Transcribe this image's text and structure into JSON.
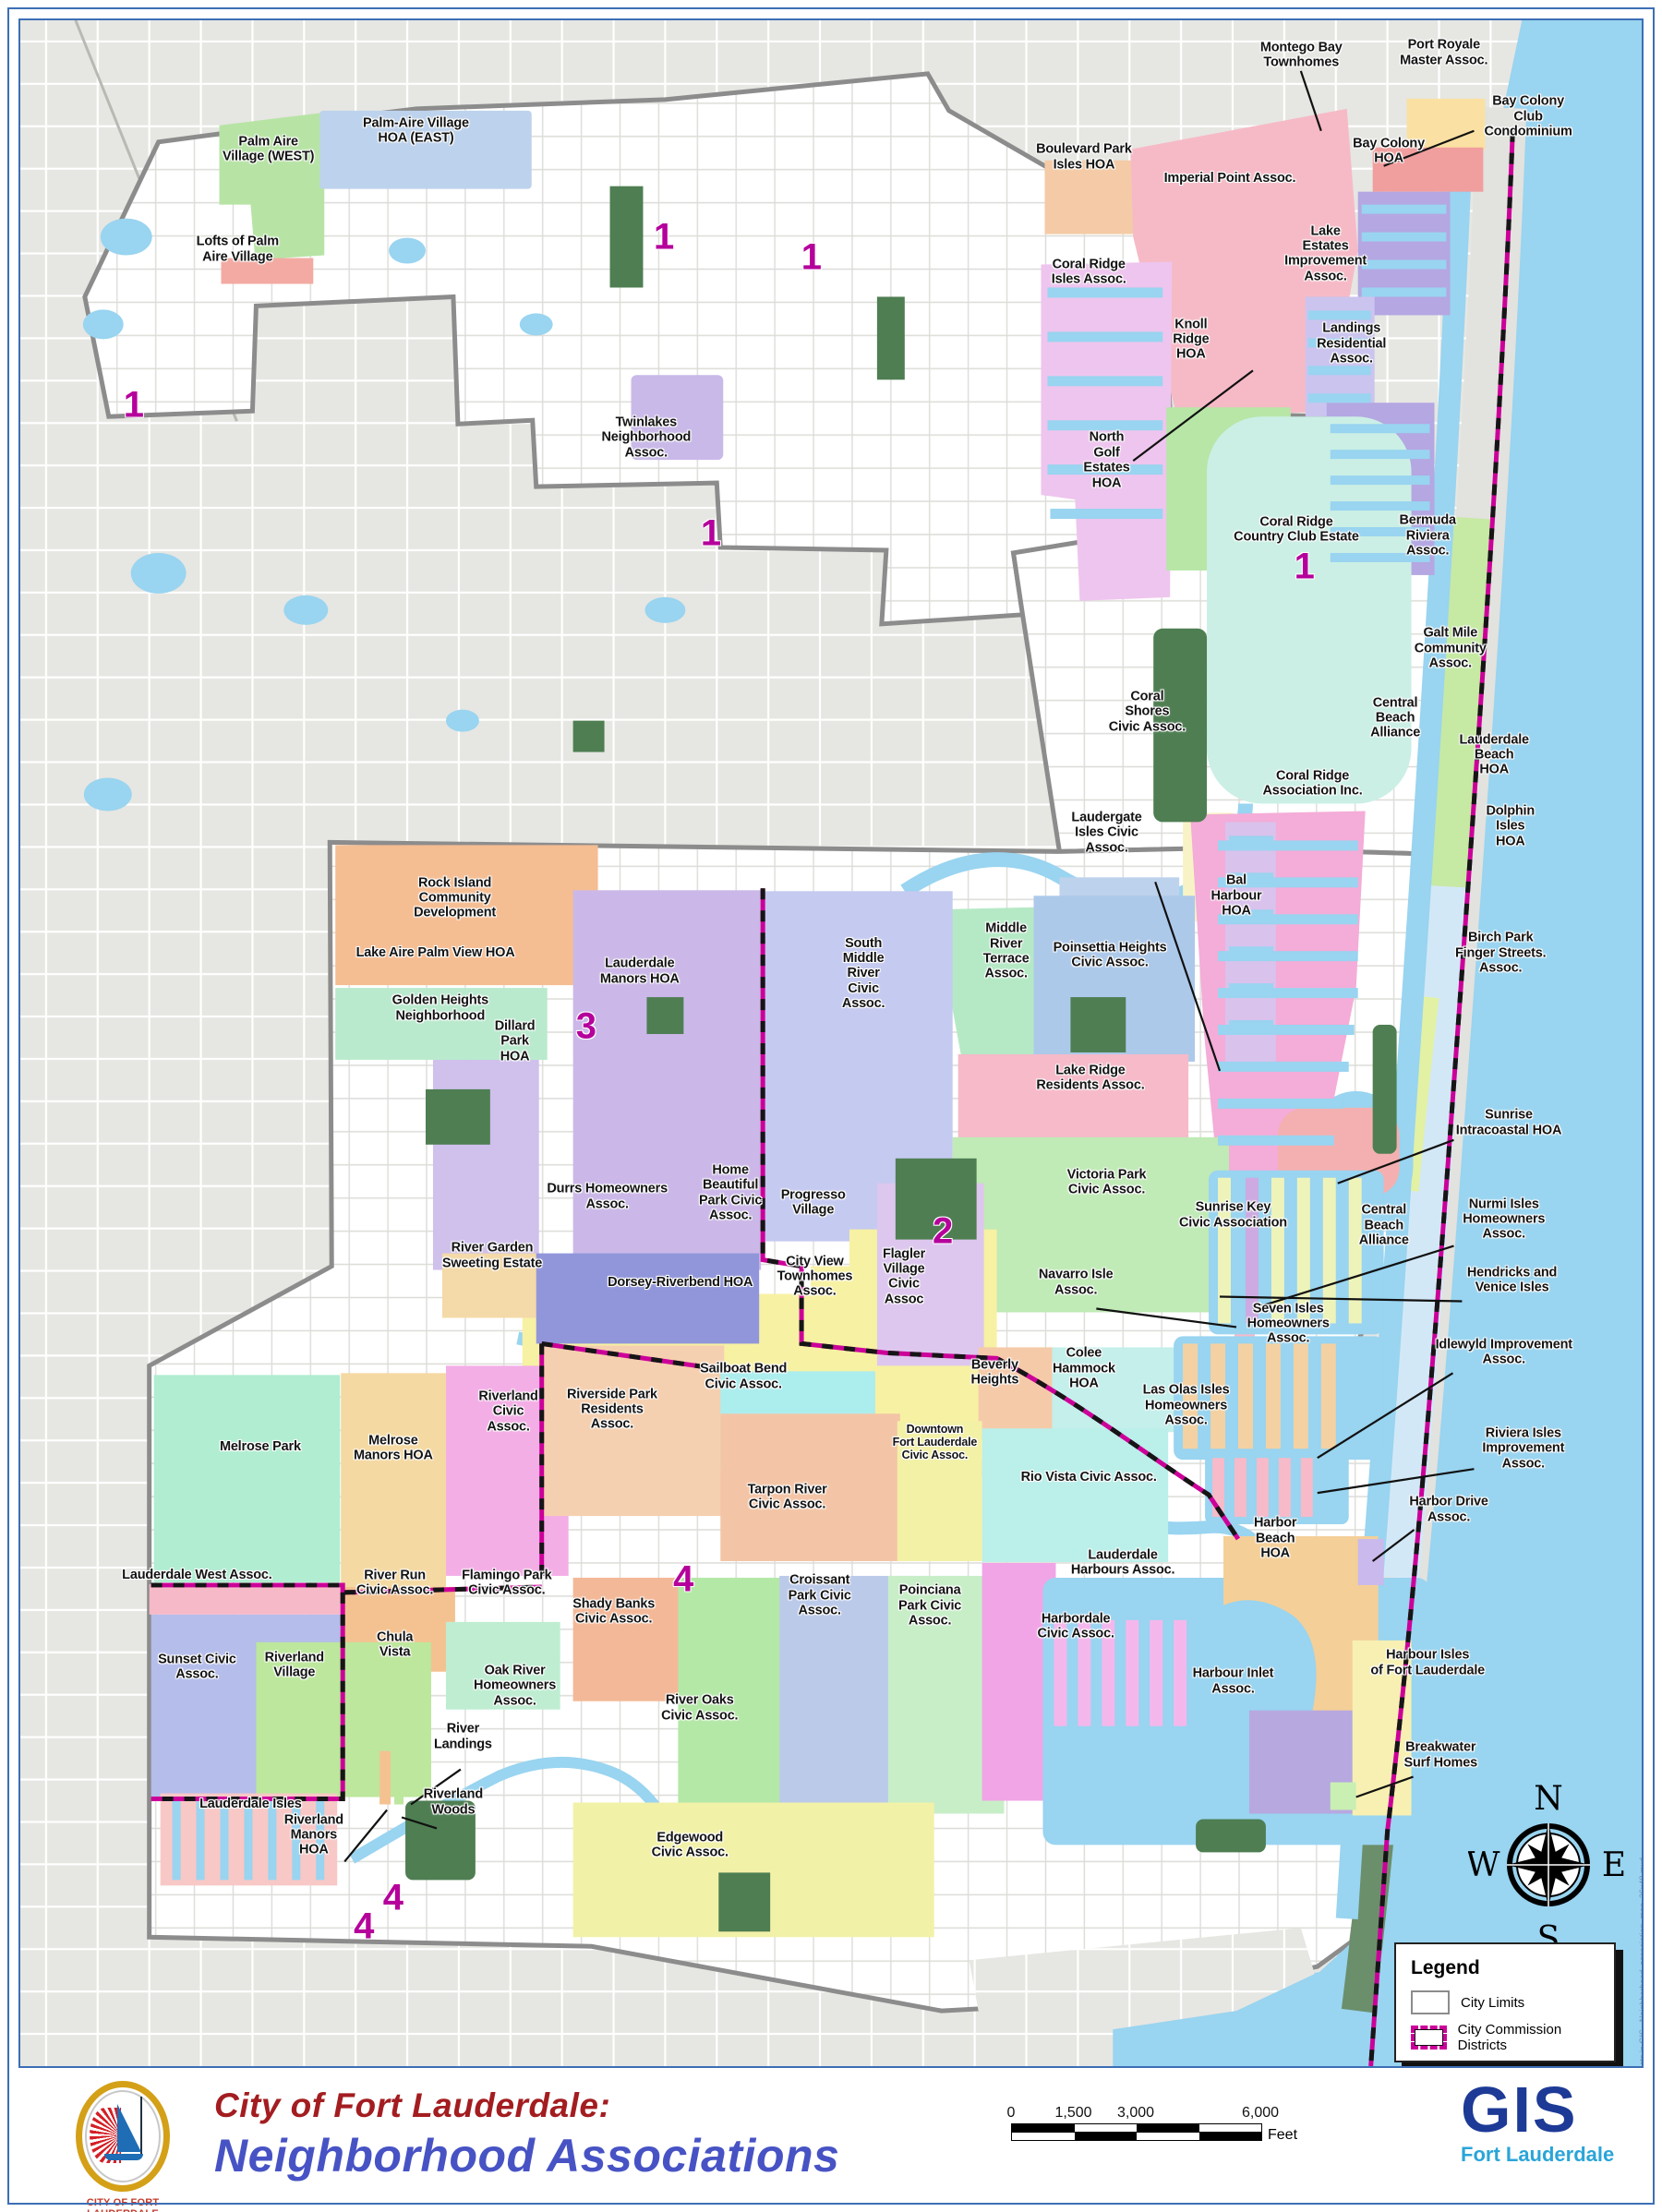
{
  "map": {
    "side_note": "Projects in GIS - Neighborhood_association_map_36x48.mxd",
    "labels": [
      {
        "id": "palm-aire-west",
        "text": "Palm Aire\nVillage (WEST)",
        "x": 15.3,
        "y": 6.3
      },
      {
        "id": "palm-aire-east",
        "text": "Palm-Aire Village\nHOA (EAST)",
        "x": 24.4,
        "y": 5.4
      },
      {
        "id": "lofts-of-palm-aire",
        "text": "Lofts of Palm\nAire Village",
        "x": 13.4,
        "y": 11.2
      },
      {
        "id": "twinlakes",
        "text": "Twinlakes\nNeighborhood\nAssoc.",
        "x": 38.6,
        "y": 20.4
      },
      {
        "id": "montego-bay",
        "text": "Montego Bay\nTownhomes",
        "x": 79.0,
        "y": 1.7
      },
      {
        "id": "port-royale",
        "text": "Port Royale\nMaster Assoc.",
        "x": 87.8,
        "y": 1.6
      },
      {
        "id": "bay-colony-club",
        "text": "Bay Colony\nClub Condominium",
        "x": 93.0,
        "y": 4.7
      },
      {
        "id": "bay-colony-hoa",
        "text": "Bay Colony\nHOA",
        "x": 84.4,
        "y": 6.4
      },
      {
        "id": "boulevard-park-isles",
        "text": "Boulevard Park\nIsles HOA",
        "x": 65.6,
        "y": 6.7
      },
      {
        "id": "imperial-point",
        "text": "Imperial Point Assoc.",
        "x": 74.6,
        "y": 7.7
      },
      {
        "id": "lake-estates",
        "text": "Lake\nEstates\nImprovement\nAssoc.",
        "x": 80.5,
        "y": 11.4
      },
      {
        "id": "coral-ridge-isles",
        "text": "Coral Ridge\nIsles Assoc.",
        "x": 65.9,
        "y": 12.3
      },
      {
        "id": "knoll-ridge",
        "text": "Knoll\nRidge\nHOA",
        "x": 72.2,
        "y": 15.6
      },
      {
        "id": "landings-residential",
        "text": "Landings\nResidential\nAssoc.",
        "x": 82.1,
        "y": 15.8
      },
      {
        "id": "north-golf-estates",
        "text": "North\nGolf\nEstates\nHOA",
        "x": 67.0,
        "y": 21.5
      },
      {
        "id": "coral-ridge-cc",
        "text": "Coral Ridge\nCountry Club Estate",
        "x": 78.7,
        "y": 24.9
      },
      {
        "id": "bermuda-riviera",
        "text": "Bermuda\nRiviera\nAssoc.",
        "x": 86.8,
        "y": 25.2
      },
      {
        "id": "galt-mile",
        "text": "Galt Mile\nCommunity\nAssoc.",
        "x": 88.2,
        "y": 30.7
      },
      {
        "id": "coral-shores",
        "text": "Coral\nShores\nCivic Assoc.",
        "x": 69.5,
        "y": 33.8
      },
      {
        "id": "central-beach-n",
        "text": "Central\nBeach\nAlliance",
        "x": 84.8,
        "y": 34.1
      },
      {
        "id": "lauderdale-beach",
        "text": "Lauderdale\nBeach\nHOA",
        "x": 90.9,
        "y": 35.9
      },
      {
        "id": "coral-ridge-assoc",
        "text": "Coral Ridge\nAssociation Inc.",
        "x": 79.7,
        "y": 37.3
      },
      {
        "id": "dolphin-isles",
        "text": "Dolphin\nIsles\nHOA",
        "x": 91.9,
        "y": 39.4
      },
      {
        "id": "laudergate-isles",
        "text": "Laudergate\nIsles Civic\nAssoc.",
        "x": 67.0,
        "y": 39.7
      },
      {
        "id": "bal-harbour",
        "text": "Bal\nHarbour\nHOA",
        "x": 75.0,
        "y": 42.8
      },
      {
        "id": "birch-park",
        "text": "Birch Park\nFinger Streets.\nAssoc.",
        "x": 91.3,
        "y": 45.6
      },
      {
        "id": "middle-river-terrace",
        "text": "Middle\nRiver\nTerrace\nAssoc.",
        "x": 60.8,
        "y": 45.5
      },
      {
        "id": "poinsettia-heights",
        "text": "Poinsettia Heights\nCivic Assoc.",
        "x": 67.2,
        "y": 45.7
      },
      {
        "id": "south-middle-river",
        "text": "South\nMiddle\nRiver\nCivic\nAssoc.",
        "x": 52.0,
        "y": 46.6
      },
      {
        "id": "rock-island",
        "text": "Rock Island\nCommunity\nDevelopment",
        "x": 26.8,
        "y": 42.9
      },
      {
        "id": "lake-aire-palm-view",
        "text": "Lake Aire Palm View HOA",
        "x": 25.6,
        "y": 45.6
      },
      {
        "id": "golden-heights",
        "text": "Golden Heights\nNeighborhood",
        "x": 25.9,
        "y": 48.3
      },
      {
        "id": "dillard-park",
        "text": "Dillard\nPark\nHOA",
        "x": 30.5,
        "y": 49.9
      },
      {
        "id": "lauderdale-manors",
        "text": "Lauderdale\nManors HOA",
        "x": 38.2,
        "y": 46.5
      },
      {
        "id": "lake-ridge",
        "text": "Lake Ridge\nResidents Assoc.",
        "x": 66.0,
        "y": 51.7
      },
      {
        "id": "sunrise-intracoastal",
        "text": "Sunrise\nIntracoastal HOA",
        "x": 91.8,
        "y": 53.9
      },
      {
        "id": "victoria-park",
        "text": "Victoria Park\nCivic Assoc.",
        "x": 67.0,
        "y": 56.8
      },
      {
        "id": "sunrise-key",
        "text": "Sunrise Key\nCivic Association",
        "x": 74.8,
        "y": 58.4
      },
      {
        "id": "central-beach-s",
        "text": "Central\nBeach\nAlliance",
        "x": 84.1,
        "y": 58.9
      },
      {
        "id": "nurmi-isles",
        "text": "Nurmi Isles\nHomeowners\nAssoc.",
        "x": 91.5,
        "y": 58.6
      },
      {
        "id": "durrs",
        "text": "Durrs Homeowners\nAssoc.",
        "x": 36.2,
        "y": 57.5
      },
      {
        "id": "home-beautiful",
        "text": "Home\nBeautiful\nPark Civic\nAssoc.",
        "x": 43.8,
        "y": 57.3
      },
      {
        "id": "progresso-village",
        "text": "Progresso\nVillage",
        "x": 48.9,
        "y": 57.8
      },
      {
        "id": "river-garden",
        "text": "River Garden\nSweeting Estate",
        "x": 29.1,
        "y": 60.4
      },
      {
        "id": "dorsey-riverbend",
        "text": "Dorsey-Riverbend HOA",
        "x": 40.7,
        "y": 61.7
      },
      {
        "id": "city-view",
        "text": "City View\nTownhomes\nAssoc.",
        "x": 49.0,
        "y": 61.4
      },
      {
        "id": "flagler-village",
        "text": "Flagler\nVillage\nCivic\nAssoc",
        "x": 54.5,
        "y": 61.4
      },
      {
        "id": "navarro-isle",
        "text": "Navarro Isle\nAssoc.",
        "x": 65.1,
        "y": 61.7
      },
      {
        "id": "hendricks-venice",
        "text": "Hendricks and\nVenice Isles",
        "x": 92.0,
        "y": 61.6
      },
      {
        "id": "seven-isles",
        "text": "Seven Isles\nHomeowners\nAssoc.",
        "x": 78.2,
        "y": 63.7
      },
      {
        "id": "idlewyld",
        "text": "Idlewyld Improvement\nAssoc.",
        "x": 91.5,
        "y": 65.1
      },
      {
        "id": "melrose-park",
        "text": "Melrose Park",
        "x": 14.8,
        "y": 69.7
      },
      {
        "id": "melrose-manors",
        "text": "Melrose\nManors HOA",
        "x": 23.0,
        "y": 69.8
      },
      {
        "id": "riverland-civic",
        "text": "Riverland\nCivic\nAssoc.",
        "x": 30.1,
        "y": 68.0
      },
      {
        "id": "riverside-park",
        "text": "Riverside Park\nResidents\nAssoc.",
        "x": 36.5,
        "y": 67.9
      },
      {
        "id": "sailboat-bend",
        "text": "Sailboat Bend\nCivic Assoc.",
        "x": 44.6,
        "y": 66.3
      },
      {
        "id": "beverly-heights",
        "text": "Beverly\nHeights",
        "x": 60.1,
        "y": 66.1
      },
      {
        "id": "colee-hammock",
        "text": "Colee\nHammock\nHOA",
        "x": 65.6,
        "y": 65.9
      },
      {
        "id": "las-olas-isles",
        "text": "Las Olas Isles\nHomeowners\nAssoc.",
        "x": 71.9,
        "y": 67.7
      },
      {
        "id": "downtown",
        "text": "Downtown\nFort Lauderdale\nCivic Assoc.",
        "x": 56.4,
        "y": 69.5,
        "size": "sm"
      },
      {
        "id": "rio-vista",
        "text": "Rio Vista Civic Assoc.",
        "x": 65.9,
        "y": 71.2
      },
      {
        "id": "riviera-isles",
        "text": "Riviera Isles\nImprovement\nAssoc.",
        "x": 92.7,
        "y": 69.8
      },
      {
        "id": "tarpon-river",
        "text": "Tarpon River\nCivic Assoc.",
        "x": 47.3,
        "y": 72.2
      },
      {
        "id": "harbor-drive",
        "text": "Harbor Drive\nAssoc.",
        "x": 88.1,
        "y": 72.8
      },
      {
        "id": "harbor-beach",
        "text": "Harbor\nBeach\nHOA",
        "x": 77.4,
        "y": 74.2
      },
      {
        "id": "lauderdale-harbours",
        "text": "Lauderdale\nHarbours Assoc.",
        "x": 68.0,
        "y": 75.4
      },
      {
        "id": "lauderdale-west",
        "text": "Lauderdale West  Assoc.",
        "x": 10.9,
        "y": 76.0
      },
      {
        "id": "river-run",
        "text": "River Run\nCivic Assoc.",
        "x": 23.1,
        "y": 76.4
      },
      {
        "id": "flamingo-park",
        "text": "Flamingo Park\nCivic Assoc.",
        "x": 30.0,
        "y": 76.4
      },
      {
        "id": "shady-banks",
        "text": "Shady Banks\nCivic Assoc.",
        "x": 36.6,
        "y": 77.8
      },
      {
        "id": "croissant-park",
        "text": "Croissant\nPark Civic\nAssoc.",
        "x": 49.3,
        "y": 77.0
      },
      {
        "id": "poinciana-park",
        "text": "Poinciana\nPark Civic\nAssoc.",
        "x": 56.1,
        "y": 77.5
      },
      {
        "id": "harbordale",
        "text": "Harbordale\nCivic Assoc.",
        "x": 65.1,
        "y": 78.5
      },
      {
        "id": "harbour-inlet",
        "text": "Harbour Inlet\nAssoc.",
        "x": 74.8,
        "y": 81.2
      },
      {
        "id": "harbour-isles",
        "text": "Harbour Isles\nof Fort Lauderdale",
        "x": 86.8,
        "y": 80.3
      },
      {
        "id": "sunset-civic",
        "text": "Sunset Civic\nAssoc.",
        "x": 10.9,
        "y": 80.5
      },
      {
        "id": "riverland-village",
        "text": "Riverland\nVillage",
        "x": 16.9,
        "y": 80.4
      },
      {
        "id": "chula-vista",
        "text": "Chula\nVista",
        "x": 23.1,
        "y": 79.4
      },
      {
        "id": "oak-river",
        "text": "Oak River\nHomeowners\nAssoc.",
        "x": 30.5,
        "y": 81.4
      },
      {
        "id": "river-oaks",
        "text": "River Oaks\nCivic Assoc.",
        "x": 41.9,
        "y": 82.5
      },
      {
        "id": "breakwater",
        "text": "Breakwater\nSurf Homes",
        "x": 87.6,
        "y": 84.8
      },
      {
        "id": "river-landings",
        "text": "River\nLandings",
        "x": 27.3,
        "y": 83.9
      },
      {
        "id": "lauderdale-isles",
        "text": "Lauderdale Isles",
        "x": 14.2,
        "y": 87.2
      },
      {
        "id": "riverland-woods",
        "text": "Riverland\nWoods",
        "x": 26.7,
        "y": 87.1
      },
      {
        "id": "riverland-manors",
        "text": "Riverland\nManors\nHOA",
        "x": 18.1,
        "y": 88.7
      },
      {
        "id": "edgewood",
        "text": "Edgewood\nCivic Assoc.",
        "x": 41.3,
        "y": 89.2
      }
    ],
    "district_numbers": [
      {
        "n": "1",
        "x": 39.7,
        "y": 10.6
      },
      {
        "n": "1",
        "x": 7.0,
        "y": 18.8
      },
      {
        "n": "1",
        "x": 48.8,
        "y": 11.6
      },
      {
        "n": "1",
        "x": 42.6,
        "y": 25.1
      },
      {
        "n": "1",
        "x": 79.2,
        "y": 26.7
      },
      {
        "n": "3",
        "x": 34.9,
        "y": 49.2
      },
      {
        "n": "2",
        "x": 56.9,
        "y": 59.2
      },
      {
        "n": "4",
        "x": 40.9,
        "y": 76.2
      },
      {
        "n": "4",
        "x": 23.0,
        "y": 91.8
      },
      {
        "n": "4",
        "x": 21.2,
        "y": 93.2
      }
    ]
  },
  "legend": {
    "title": "Legend",
    "items": [
      {
        "label": "City Limits",
        "swatch": "city-limits"
      },
      {
        "label": "City Commission Districts",
        "swatch": "commission-districts"
      }
    ]
  },
  "compass": {
    "n": "N",
    "e": "E",
    "s": "S",
    "w": "W"
  },
  "scalebar": {
    "ticks": [
      "0",
      "1,500",
      "3,000",
      "6,000"
    ],
    "unit": "Feet"
  },
  "footer": {
    "title_line1": "City of Fort Lauderdale:",
    "title_line2": "Neighborhood Associations",
    "seal_caption": "CITY OF FORT LAUDERDALE",
    "gis": "GIS",
    "gis_sub": "Fort Lauderdale"
  },
  "colors": {
    "base": {
      "page_border": "#3d6fb5",
      "map_bg_outside": "#e6e6e2",
      "city_fill": "#ffffff",
      "water": "#99d4f0",
      "park": "#4e7e52",
      "jetty_green": "#6b8f6b",
      "city_limits_line": "#8c8c8c",
      "district_line_magenta": "#cc0099",
      "district_line_black": "#151515",
      "district_number_color": "#b5009b",
      "barrier_gray": "#e2e2de"
    },
    "footer_colors": {
      "title_red": "#a31d20",
      "title_blue": "#4753c4",
      "gis_navy": "#1d3a96",
      "gis_cyan": "#2aa5d8",
      "logo_gold": "#d4a017",
      "logo_red": "#d42027",
      "logo_blue": "#1f6db5",
      "caption_red": "#c23a2a"
    },
    "regions": {
      "palm_aire_west": "#b7e4a5",
      "palm_aire_east": "#bdd2ec",
      "lofts_palm_aire": "#f2aaa2",
      "twinlakes": "#c9b9e8",
      "montego_bay": "#f5b9c3",
      "port_royale": "#fae0a2",
      "bay_colony_club": "#f09e9e",
      "bay_colony_hoa": "#b4a7e2",
      "boulevard_park": "#f4cba6",
      "imperial_point": "#f6bac6",
      "coral_ridge_isles": "#eec5ee",
      "knoll_ridge": "#b7e6a7",
      "lake_estates": "#cbc4ee",
      "landings": "#b4a7e2",
      "coral_ridge_cc": "#cbefe5",
      "bermuda_riviera": "#c6e9a4",
      "galt_mile": "#c6e9a4",
      "coral_shores": "#f8f3c6",
      "coral_ridge_assoc": "#f4acd8",
      "central_beach": "#d3e8f6",
      "birch_park": "#e2f1a3",
      "laudergate": "#bdd2ec",
      "bal_harbour": "#d9c2ec",
      "middle_river_terrace": "#b5e9c5",
      "poinsettia": "#adc9ea",
      "lake_ridge": "#f6bac9",
      "victoria_park": "#c0eab6",
      "south_middle_river": "#c5caf0",
      "rock_island": "#f5bd92",
      "lake_aire": "#b9eacd",
      "dillard_park": "#cfc0ec",
      "lauderdale_manors": "#cbb8e8",
      "durrs": "#f7f1a3",
      "progresso": "#f7f1a3",
      "river_garden": "#f4daa8",
      "dorsey": "#9196da",
      "city_view": "#f7f1a3",
      "flagler": "#ddc7ee",
      "sunrise_key": "#f4b0b0",
      "seven_isles": "#eef3ba",
      "nurmi": "#cdabe2",
      "las_olas": "#f4d1a2",
      "colee_hammock": "#c4efeb",
      "beverly_heights": "#f5caa9",
      "downtown": "#f3f1a6",
      "rio_vista": "#bbefe9",
      "sailboat_bend": "#aceded",
      "riverside_park": "#f5d0b0",
      "tarpon_river": "#f3c5a6",
      "navarro": "#f6bac9",
      "idlewyld": "#f6b8c8",
      "riviera_isles": "#f6bac9",
      "melrose_park": "#b0edd1",
      "melrose_manors": "#f5d9a2",
      "riverland_civic": "#f3aee6",
      "lauderdale_west": "#f6b9c8",
      "sunset": "#b5bdea",
      "river_run": "#f4c291",
      "flamingo_park": "#bfedd2",
      "riverland_village": "#bce79c",
      "shady_banks": "#f3b897",
      "river_oaks": "#b4e8a7",
      "croissant_park": "#bccaea",
      "poinciana_park": "#c8eec8",
      "harbordale": "#f1a5e6",
      "lauderdale_harbours": "#f4b7ec",
      "harbor_beach": "#f4cf98",
      "harbor_drive": "#cab9ec",
      "harbour_inlet": "#b7a8e0",
      "harbour_isles": "#f7f0b2",
      "breakwater": "#c9efb2",
      "lauderdale_isles": "#f8c8c6",
      "edgewood": "#f2f1a8",
      "river_landings_a": "#f4c291",
      "river_landings_b": "#bce79c"
    }
  }
}
